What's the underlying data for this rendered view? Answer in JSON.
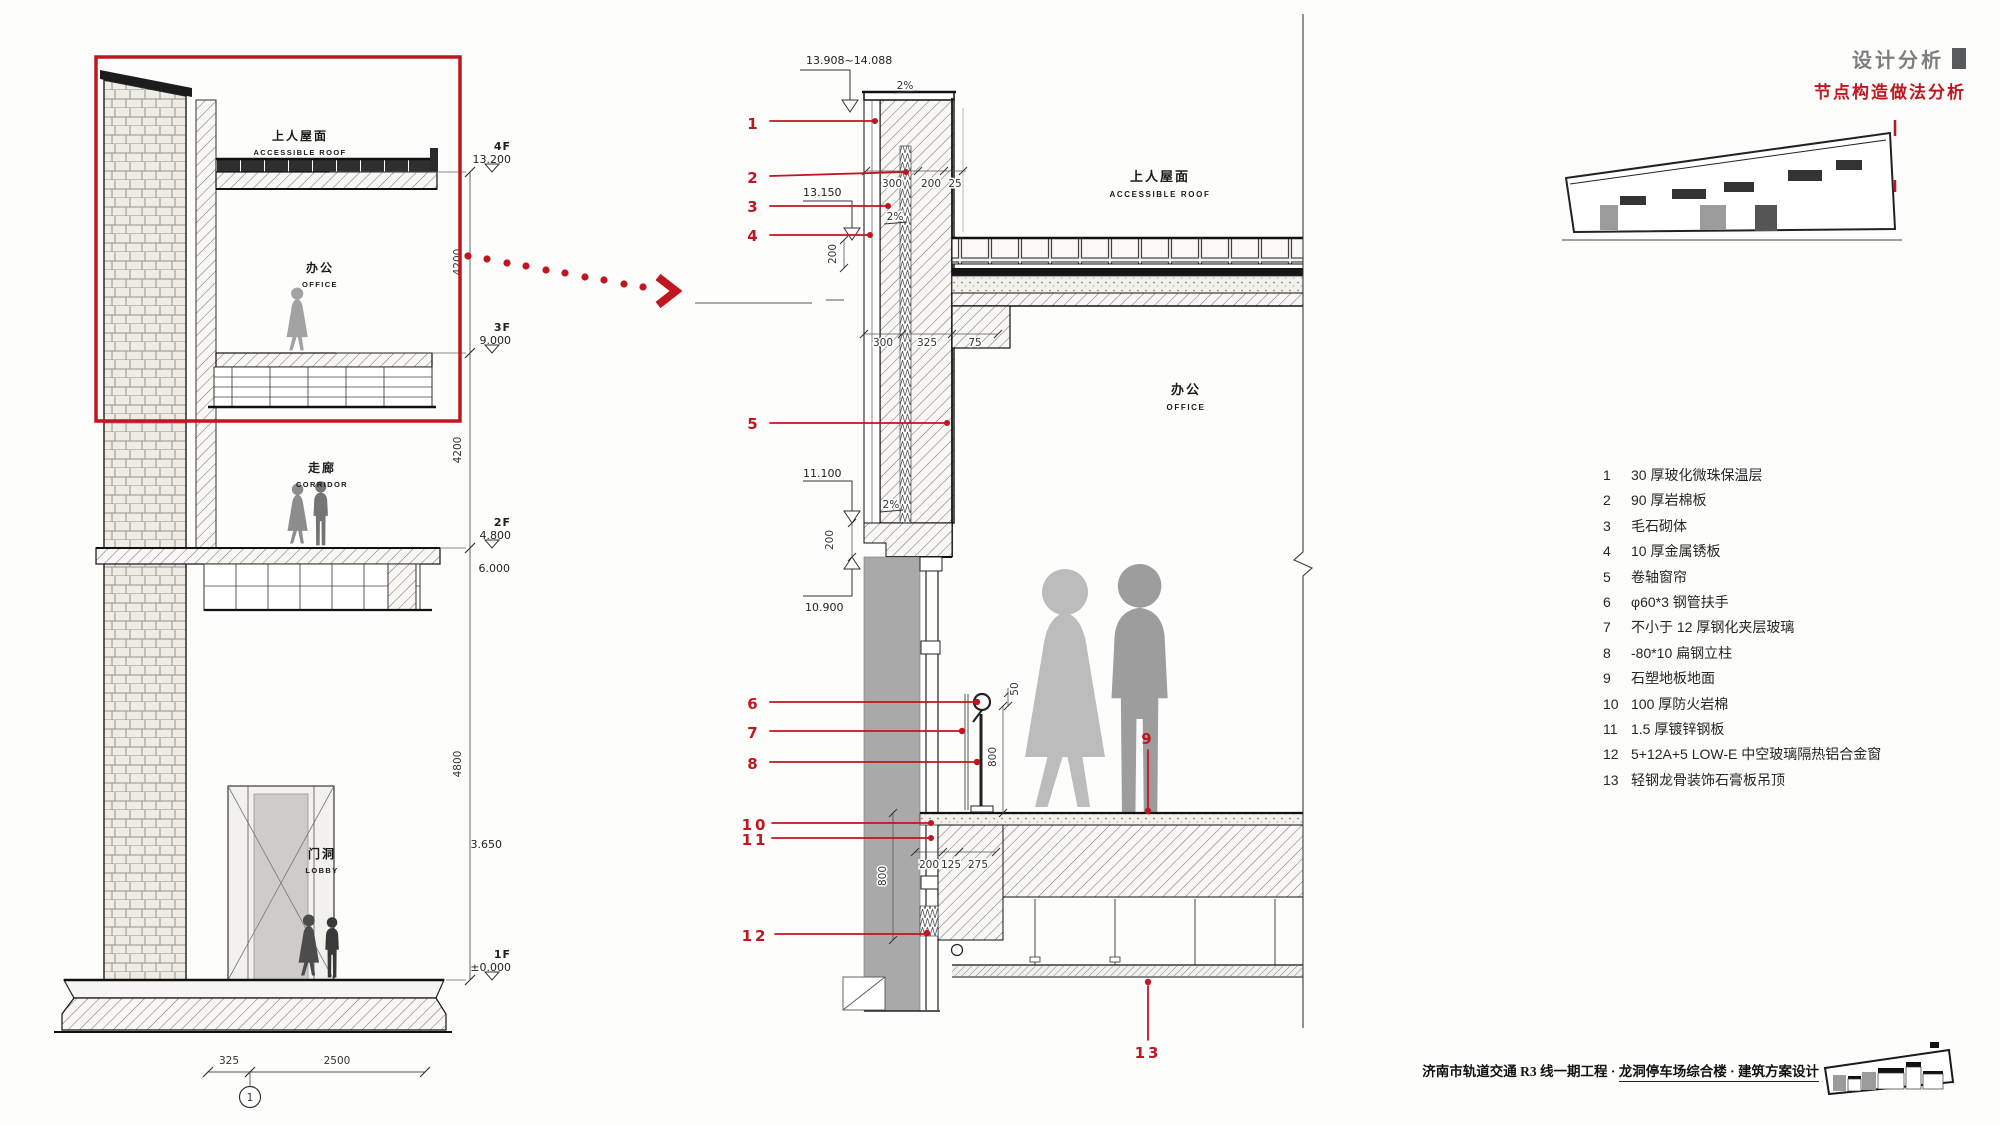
{
  "header": {
    "section_title": "设计分析",
    "subtitle": "节点构造做法分析"
  },
  "footer": {
    "project_title_part1": "济南市轨道交通 R3 线一期工程 ·",
    "project_title_part2": "龙洞停车场综合楼 · 建筑方案设计"
  },
  "colors": {
    "accent_red": "#c0161f",
    "line_dark": "#1a1a1a",
    "blind_grey": "#a9a9a9",
    "silhouette_grey": "#b5b5b5",
    "title_grey": "#7e7e7e"
  },
  "left_section": {
    "labels": {
      "roof_cn": "上人屋面",
      "roof_en": "ACCESSIBLE ROOF",
      "office_cn": "办公",
      "office_en": "OFFICE",
      "corridor_cn": "走廊",
      "corridor_en": "CORRIDOR",
      "lobby_cn": "门洞",
      "lobby_en": "LOBBY"
    },
    "levels": [
      {
        "floor": "4F",
        "elev": "13.200"
      },
      {
        "floor": "3F",
        "elev": "9.000"
      },
      {
        "floor": "2F",
        "elev": "4.800"
      },
      {
        "floor": "1F",
        "elev": "±0.000"
      }
    ],
    "aux_levels": [
      "6.000",
      "3.650"
    ],
    "story_dims": [
      "4200",
      "4200",
      "4800"
    ],
    "bottom_dims": [
      "325",
      "2500"
    ],
    "axis_label": "1"
  },
  "detail_section": {
    "labels": {
      "roof_cn": "上人屋面",
      "roof_en": "ACCESSIBLE ROOF",
      "office_cn": "办公",
      "office_en": "OFFICE"
    },
    "levels": [
      "13.908~14.088",
      "13.150",
      "11.100",
      "10.900"
    ],
    "slopes": [
      "2%",
      "2%",
      "2%"
    ],
    "dims": {
      "parapet_row": [
        "300",
        "200",
        "25"
      ],
      "parapet_height": "200",
      "roof_row": [
        "300",
        "325",
        "75"
      ],
      "window_head": "200",
      "rail_offset": "50",
      "rail_height": "800",
      "floor_row": [
        "200",
        "125",
        "275"
      ],
      "sill_height": "800"
    },
    "callouts": [
      "1",
      "2",
      "3",
      "4",
      "5",
      "6",
      "7",
      "8",
      "9",
      "10",
      "11",
      "12",
      "13"
    ]
  },
  "legend": {
    "items": [
      {
        "num": "1",
        "text": "30 厚玻化微珠保温层"
      },
      {
        "num": "2",
        "text": "90 厚岩棉板"
      },
      {
        "num": "3",
        "text": "毛石砌体"
      },
      {
        "num": "4",
        "text": "10 厚金属锈板"
      },
      {
        "num": "5",
        "text": "卷轴窗帘"
      },
      {
        "num": "6",
        "text": "φ60*3 钢管扶手"
      },
      {
        "num": "7",
        "text": "不小于 12 厚钢化夹层玻璃"
      },
      {
        "num": "8",
        "text": "-80*10 扁钢立柱"
      },
      {
        "num": "9",
        "text": "石塑地板地面"
      },
      {
        "num": "10",
        "text": "100 厚防火岩棉"
      },
      {
        "num": "11",
        "text": "1.5 厚镀锌钢板"
      },
      {
        "num": "12",
        "text": "5+12A+5 LOW-E 中空玻璃隔热铝合金窗"
      },
      {
        "num": "13",
        "text": "轻钢龙骨装饰石膏板吊顶"
      }
    ]
  }
}
